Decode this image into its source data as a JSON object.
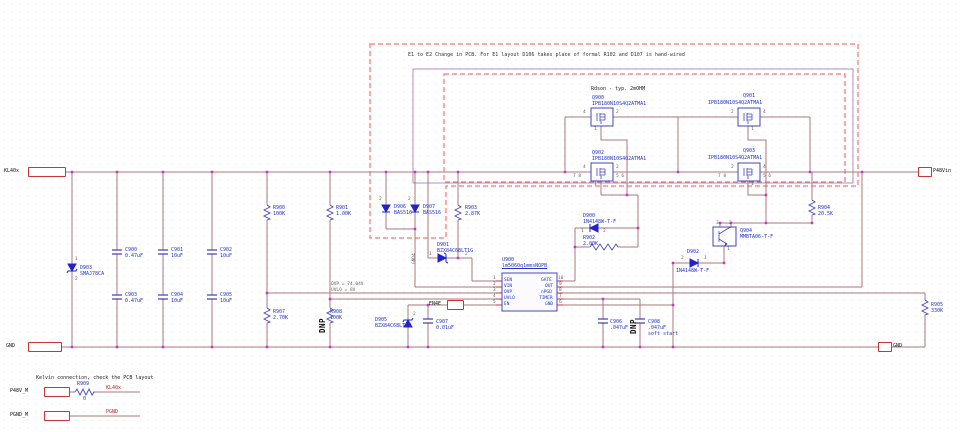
{
  "notes": {
    "change_note": "E1 to E2 Change in PCB. For E1 layout D106 takes place of formal R102 and D107 is hand-wired",
    "rdson": "Rdson - typ. 2mOHM",
    "ovp": "OVP = 74.04V",
    "uvlo": "UVLO = 8V",
    "kelvin": "Kelvin connection, check the PCB layout",
    "soft_start": "soft start",
    "dnp": "DNP",
    "gnd4": "GND4"
  },
  "ports": {
    "kl40x": "KL40x",
    "p48vin": "P48Vin",
    "gnd_left": "GND",
    "gnd_right": "GND",
    "en4e": "EN4E",
    "p48v_m": "P48V_M",
    "pgnd_m": "PGND_M"
  },
  "net_labels": {
    "kl40x": "KL40x",
    "pgnd": "PGND"
  },
  "components": {
    "c900": {
      "ref": "C900",
      "value": "0.47uF"
    },
    "c901": {
      "ref": "C901",
      "value": "10uF"
    },
    "c902": {
      "ref": "C902",
      "value": "10uF"
    },
    "c903": {
      "ref": "C903",
      "value": "0.47uF"
    },
    "c904": {
      "ref": "C904",
      "value": "10uF"
    },
    "c905": {
      "ref": "C905",
      "value": "10uF"
    },
    "c906": {
      "ref": "C906",
      "value": ".047uF"
    },
    "c907": {
      "ref": "C907",
      "value": "0.01uF"
    },
    "c908": {
      "ref": "C908",
      "value": ".047uF"
    },
    "d900": {
      "ref": "D900",
      "value": "1N4148W-T-F",
      "pin_left": "1",
      "pin_right": "2"
    },
    "d901": {
      "ref": "D901",
      "value": "BZX84C68LT1G",
      "pin_left": "1",
      "pin_right": "2"
    },
    "d902": {
      "ref": "D902",
      "value": "1N4148W-T-F",
      "pin_left": "2",
      "pin_right": "1"
    },
    "d903": {
      "ref": "D903",
      "value": "SMAJ78CA",
      "pin_top": "1",
      "pin_bottom": "2"
    },
    "d905": {
      "ref": "D905",
      "value": "BZX84C68LT1G",
      "pin_top": "2"
    },
    "d906": {
      "ref": "D906",
      "value": "BAS516",
      "pin_top": "2"
    },
    "d907": {
      "ref": "D907",
      "value": "BAS516",
      "pin_top": "2"
    },
    "q900": {
      "ref": "Q900",
      "part": "IPB180N10S4Q2ATMA1",
      "pin_left": "4",
      "pin_right": "2",
      "pin_gate": "1"
    },
    "q901": {
      "ref": "Q901",
      "part": "IPB180N10S4Q2ATMA1",
      "pin_left": "2",
      "pin_right": "4",
      "pin_gate": "1"
    },
    "q902": {
      "ref": "Q902",
      "part": "IPB180N10S4Q2ATMA1",
      "pin_left": "4",
      "pin_right": "2",
      "pin_gate": "1",
      "extra_left": "7 8",
      "extra_right": "5 6"
    },
    "q903": {
      "ref": "Q903",
      "part": "IPB180N10S4Q2ATMA1",
      "pin_left": "2",
      "pin_right": "4",
      "pin_gate": "1",
      "extra_left": "7 8",
      "extra_right": "5 6"
    },
    "q904": {
      "ref": "Q904",
      "part": "MMBTA06-T-F",
      "pin_a": "3",
      "pin_b": "2",
      "pin_c": "1"
    },
    "r900": {
      "ref": "R900",
      "value": "100K"
    },
    "r901": {
      "ref": "R901",
      "value": "1.00K"
    },
    "r902": {
      "ref": "R902",
      "value": "2.00K"
    },
    "r903": {
      "ref": "R903",
      "value": "2.87K"
    },
    "r904": {
      "ref": "R904",
      "value": "20.5K"
    },
    "r905": {
      "ref": "R905",
      "value": "330K"
    },
    "r907": {
      "ref": "R907",
      "value": "2.70K"
    },
    "r908": {
      "ref": "R908",
      "value": "100K"
    },
    "r909": {
      "ref": "R909",
      "value": "0"
    }
  },
  "u900": {
    "ref": "U900",
    "part": "lm5060q1mmsNOPB",
    "left_pins": [
      {
        "num": "1",
        "name": "SEN"
      },
      {
        "num": "2",
        "name": "VIN"
      },
      {
        "num": "3",
        "name": "OVP"
      },
      {
        "num": "4",
        "name": "UVLO"
      },
      {
        "num": "5",
        "name": "EN"
      }
    ],
    "right_pins": [
      {
        "num": "10",
        "name": "GATE"
      },
      {
        "num": "9",
        "name": "OUT"
      },
      {
        "num": "8",
        "name": "nPGD"
      },
      {
        "num": "7",
        "name": "TIMER"
      },
      {
        "num": "6",
        "name": "GND"
      }
    ]
  },
  "colors": {
    "wire": "#a97a7e",
    "symbol": "#4444bb",
    "label": "#2233cc",
    "net": "#cc2222",
    "dashed": "#ff7070",
    "junction": "#cc33cc",
    "pin_stub": "#cc3333"
  }
}
